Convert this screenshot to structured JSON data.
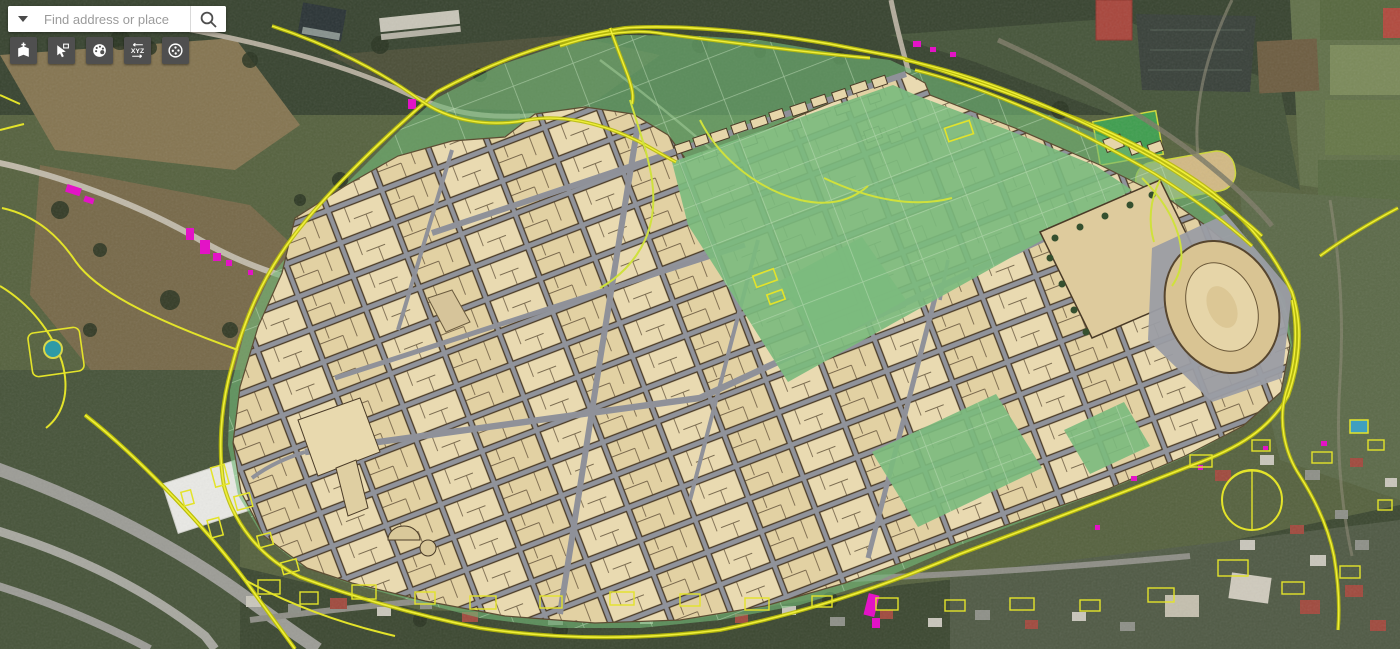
{
  "search": {
    "placeholder": "Find address or place",
    "dropdown_icon": "chevron-down-icon",
    "search_icon": "magnifier-icon"
  },
  "toolbar": {
    "buttons": [
      {
        "id": "add-data",
        "icon": "map-add-icon"
      },
      {
        "id": "select-identify",
        "icon": "select-cursor-icon"
      },
      {
        "id": "draw-style",
        "icon": "palette-icon"
      },
      {
        "id": "coordinate-conversion",
        "icon": "xyz-arrows-icon",
        "icon_text": "XYZ"
      },
      {
        "id": "points-tool",
        "icon": "dotted-circle-icon"
      }
    ]
  },
  "map": {
    "subject": "Satellite basemap of the Pompeii excavation area with GIS overlay layers",
    "overlays": [
      {
        "layer": "archaeological-park-area",
        "color": "#72b877"
      },
      {
        "layer": "excavated-insulae-blocks",
        "color": "#e8d9b0"
      },
      {
        "layer": "ancient-streets-grid",
        "color": "#8f9199"
      },
      {
        "layer": "modern-cad-linework",
        "color": "#e8e414"
      },
      {
        "layer": "highlighted-features",
        "color": "#e313c6"
      },
      {
        "layer": "amphitheatre",
        "color": "#d9c493"
      }
    ]
  },
  "colors": {
    "toolbar_button_bg": "#4f4f4f",
    "toolbar_icon": "#ffffff",
    "search_bg": "#ffffff",
    "placeholder_text": "#9b9b9b"
  }
}
